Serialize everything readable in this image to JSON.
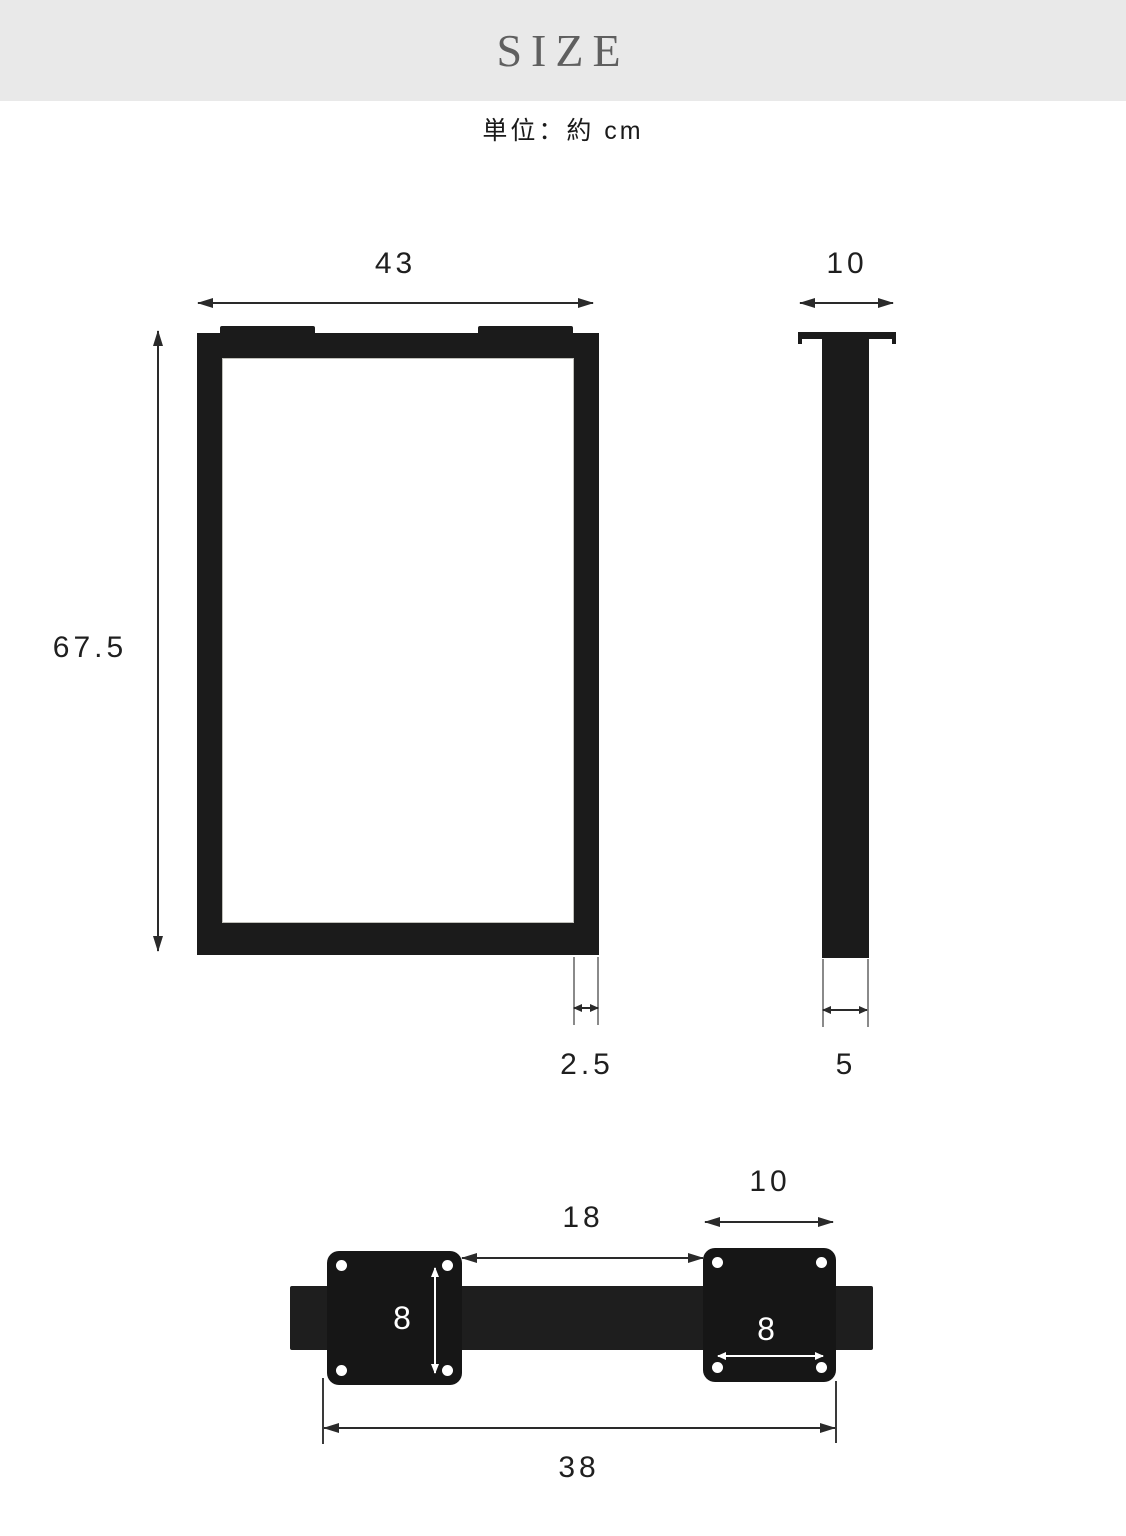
{
  "header": {
    "title": "SIZE"
  },
  "unit_note": "単位：約 cm",
  "front_view": {
    "width": "43",
    "height": "67.5",
    "leg_thickness": "2.5"
  },
  "side_view": {
    "depth_top": "10",
    "depth_bottom": "5"
  },
  "crossbar_view": {
    "inner_span": "18",
    "plate_width": "10",
    "left_plate_hole_pitch": "8",
    "right_plate_hole_pitch": "8",
    "overall_length": "38"
  },
  "colors": {
    "header_bg": "#e9e9e9",
    "header_text": "#5f5f5f",
    "metal_black": "#1b1b1b",
    "dimension_line": "#2a2a2a",
    "white_marking": "#ffffff"
  }
}
